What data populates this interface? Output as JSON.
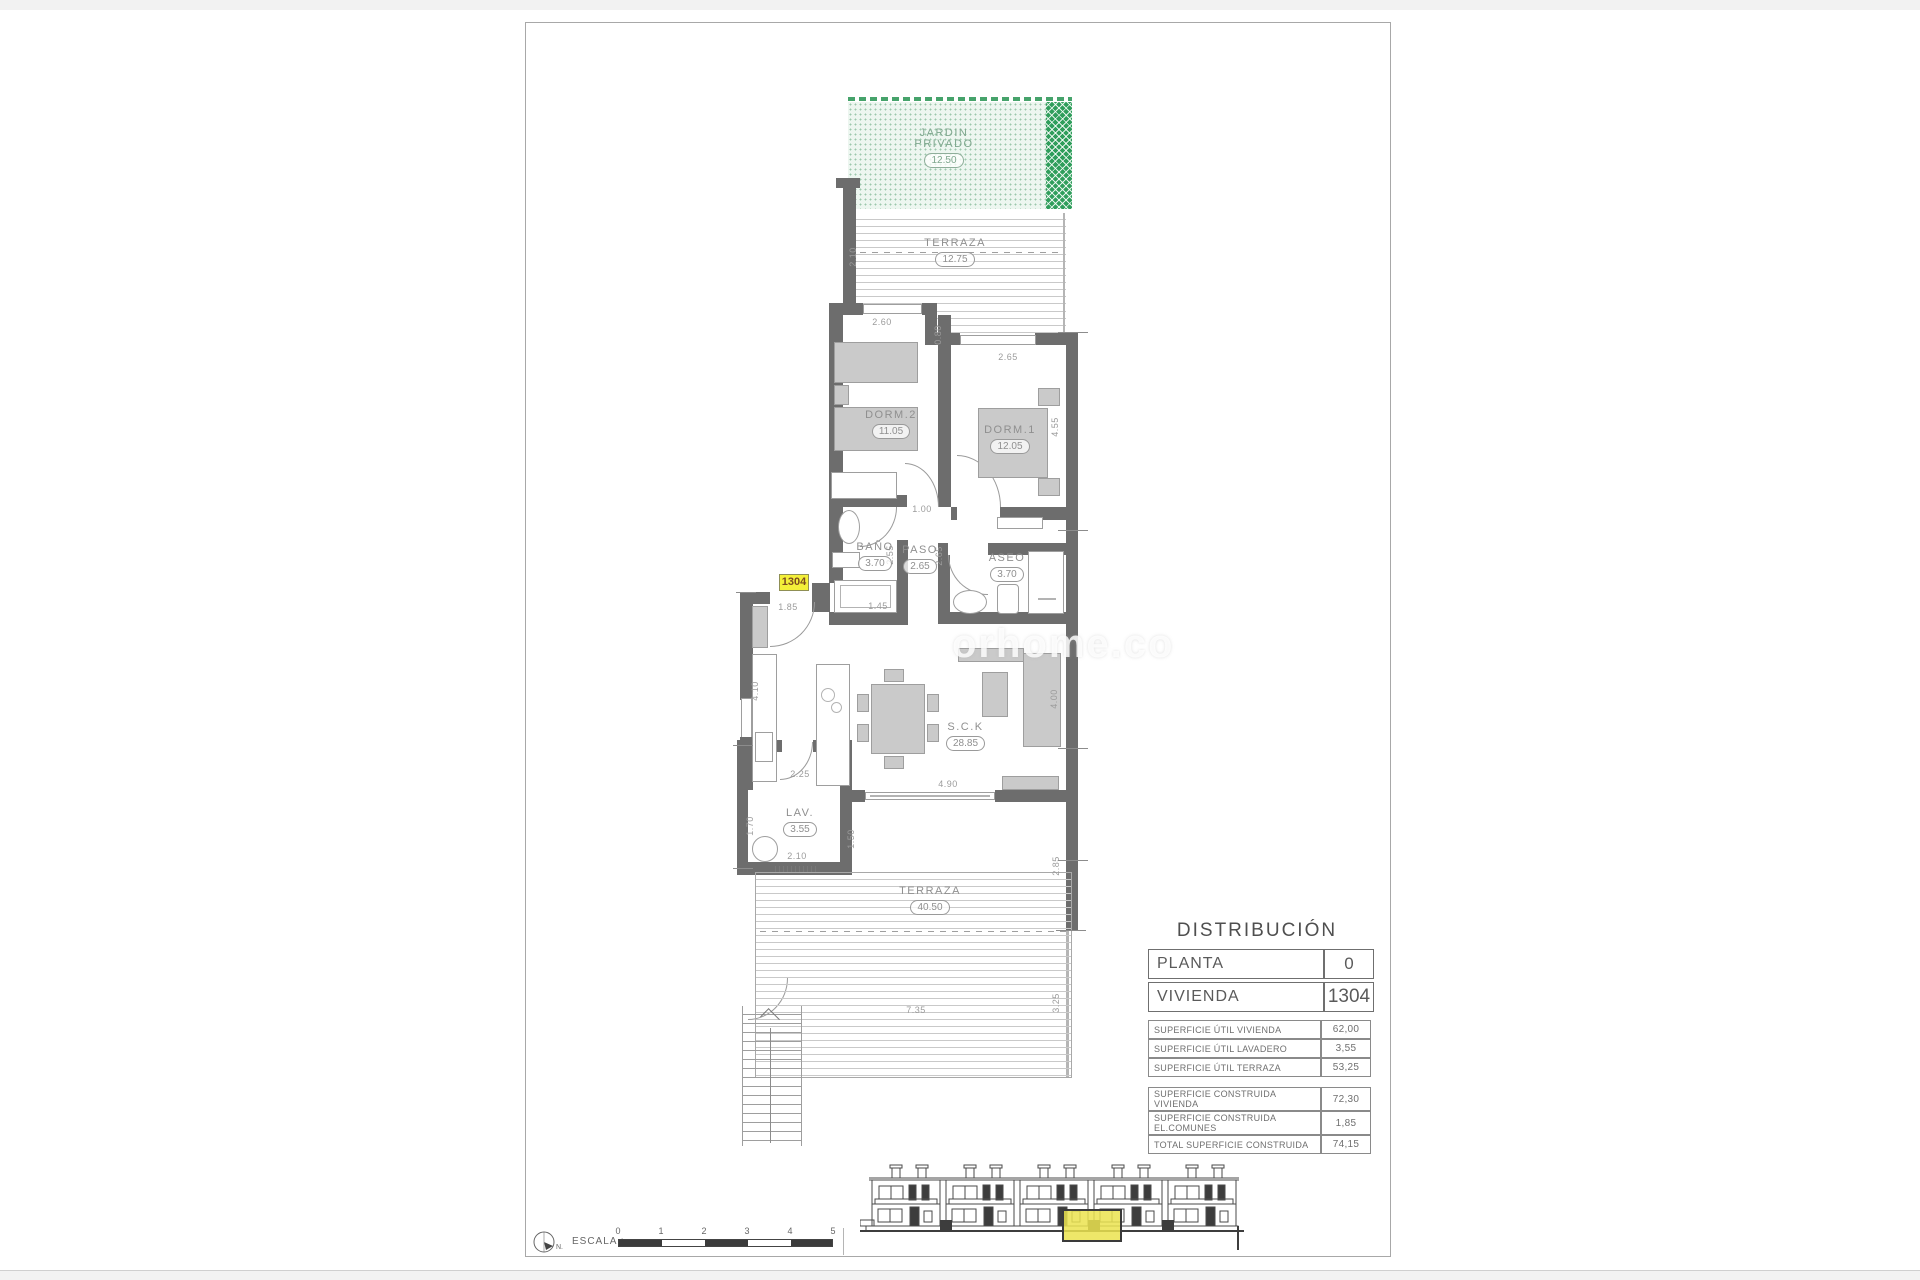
{
  "watermark": {
    "text": "orhome.co"
  },
  "colors": {
    "wall": "#6d6d6d",
    "furniture": "#cacaca",
    "garden_light": "#edf6f0",
    "garden_dark": "#2f9e5b",
    "highlight_yellow": "#f3ef39",
    "elevation_highlight": "#ebe34f"
  },
  "plan": {
    "unit_tag": "1304",
    "rooms": [
      {
        "name": "JARDIN PRIVADO",
        "area": "12.50"
      },
      {
        "name": "TERRAZA",
        "area": "12.75"
      },
      {
        "name": "DORM.2",
        "area": "11.05"
      },
      {
        "name": "DORM.1",
        "area": "12.05"
      },
      {
        "name": "BAÑO",
        "area": "3.70"
      },
      {
        "name": "PASO",
        "area": "2.65"
      },
      {
        "name": "ASEO",
        "area": "3.70"
      },
      {
        "name": "S.C.K",
        "area": "28.85"
      },
      {
        "name": "LAV.",
        "area": "3.55"
      },
      {
        "name": "TERRAZA",
        "area": "40.50"
      }
    ],
    "dimensions": [
      "2.10",
      "2.60",
      "0.80",
      "2.65",
      "4.55",
      "1.00",
      "2.55",
      "2.65",
      "1.85",
      "1.45",
      "4.10",
      "2.25",
      "4.90",
      "4.00",
      "1.70",
      "2.10",
      "1.50",
      "2.85",
      "7.35",
      "3.25"
    ]
  },
  "distribution": {
    "title": "DISTRIBUCIÓN",
    "main_rows": [
      {
        "label": "PLANTA",
        "value": "0"
      },
      {
        "label": "VIVIENDA",
        "value": "1304"
      }
    ],
    "util_rows": [
      {
        "label": "SUPERFICIE ÚTIL VIVIENDA",
        "value": "62,00"
      },
      {
        "label": "SUPERFICIE ÚTIL LAVADERO",
        "value": "3,55"
      },
      {
        "label": "SUPERFICIE ÚTIL TERRAZA",
        "value": "53,25"
      }
    ],
    "constr_rows": [
      {
        "label": "SUPERFICIE CONSTRUIDA VIVIENDA",
        "value": "72,30"
      },
      {
        "label": "SUPERFICIE CONSTRUIDA EL.COMUNES",
        "value": "1,85"
      },
      {
        "label": "TOTAL SUPERFICIE CONSTRUIDA",
        "value": "74,15"
      }
    ]
  },
  "scale_bar": {
    "label": "ESCALA :",
    "north_label": "N.",
    "ticks": [
      "0",
      "1",
      "2",
      "3",
      "4",
      "5"
    ]
  }
}
